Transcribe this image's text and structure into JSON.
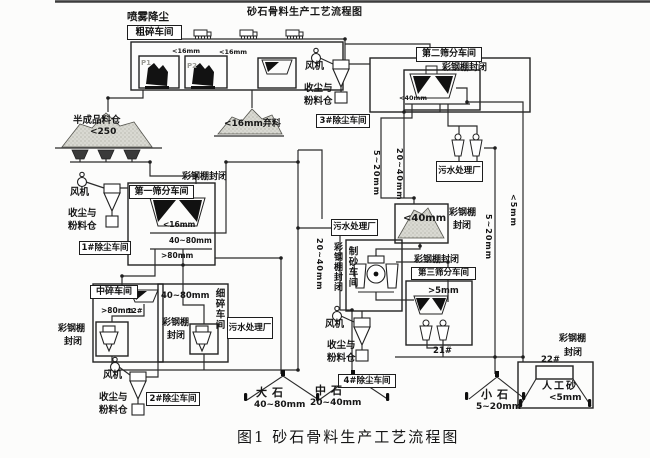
{
  "title": "砂石骨料生产工艺流程图",
  "caption": "图1  砂石骨料生产工艺流程图",
  "coarse": {
    "spray": "喷雾降尘",
    "name": "粗碎车间",
    "p1": "P1",
    "p2": "P2",
    "fines1": "<16mm",
    "fines2": "<16mm"
  },
  "semi_bin": {
    "name": "半成品料仓",
    "size": "<250"
  },
  "waste_pile": {
    "label": "<16mm弃料"
  },
  "dust1": {
    "fan": "风机",
    "bin1": "收尘与",
    "bin2": "粉料仓",
    "name": "1#除尘车间"
  },
  "dust2": {
    "fan": "风机",
    "bin1": "收尘与",
    "bin2": "粉料仓",
    "name": "2#除尘车间"
  },
  "dust3": {
    "fan": "风机",
    "bin1": "收尘与",
    "bin2": "粉料仓",
    "name": "3#除尘车间"
  },
  "dust4": {
    "fan": "风机",
    "bin1": "收尘与",
    "bin2": "粉料仓",
    "name": "4#除尘车间"
  },
  "screen1": {
    "name": "第一筛分车间",
    "shed": "彩钢棚封闭",
    "out_fine": "<16mm",
    "out_mid": "40~80mm",
    "out_big": ">80mm"
  },
  "screen2": {
    "name": "第二筛分车间",
    "shed": "彩钢棚封闭",
    "out_fine": "<40mm"
  },
  "screen3": {
    "name": "第三筛分车间",
    "shed": "彩钢棚封闭",
    "recycle": ">5mm"
  },
  "mid_crush": {
    "name": "中碎车间",
    "feed": ">80mm",
    "belt": "12#",
    "shed1": "彩钢棚",
    "shed2": "封闭"
  },
  "fine_crush": {
    "name": "细碎车间",
    "feed": "40~80mm",
    "shed1": "彩钢棚",
    "shed2": "封闭"
  },
  "sand_plant": {
    "name": "制砂车间",
    "shed": "彩钢棚封闭"
  },
  "sewage1": {
    "label": "污水处理厂"
  },
  "sewage2": {
    "label": "污水处理厂"
  },
  "sewage3": {
    "label": "污水处理厂"
  },
  "mid_pile": {
    "label": "<40mm",
    "shed1": "彩钢棚",
    "shed2": "封闭"
  },
  "flow_labels": {
    "s520a": "5~20mm",
    "s2040a": "20~40mm",
    "s2040b": "20~40mm",
    "s520b": "5~20mm",
    "lt5": "<5mm",
    "belt21": "21#",
    "belt22": "22#"
  },
  "products": {
    "big": {
      "name": "大石",
      "size": "40~80mm"
    },
    "mid": {
      "name": "中石",
      "size": "20~40mm"
    },
    "small": {
      "name": "小石",
      "size": "5~20mm"
    },
    "sand": {
      "name": "人工砂",
      "size": "<5mm",
      "shed1": "彩钢棚",
      "shed2": "封闭"
    }
  }
}
